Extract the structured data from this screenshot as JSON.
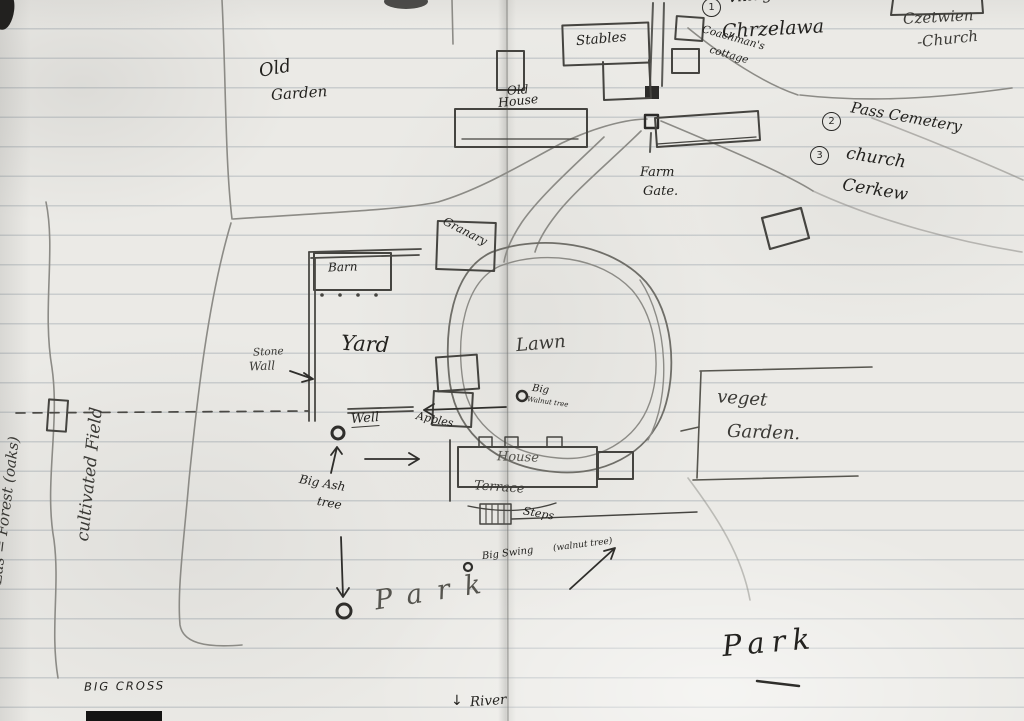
{
  "colors": {
    "paper": "#ebeae6",
    "rule_line": "#7d8a96",
    "pencil_dark": "#23221f",
    "pencil": "#3b3a36",
    "pencil_light": "#8c8b86"
  },
  "labels": {
    "village": {
      "num": "1",
      "line1": "village",
      "line2": "Chrzelawa"
    },
    "czetwien_church": {
      "line1": "Czetwien",
      "line2": "-Church"
    },
    "pass_cemetery": {
      "num": "2",
      "text": "Pass Cemetery"
    },
    "church_cerkew": {
      "num": "3",
      "line1": "church",
      "line2": "Cerkew"
    },
    "stables": "Stables",
    "coachmans_cottage": {
      "line1": "Coachman's",
      "line2": "cottage"
    },
    "old_garden": {
      "line1": "Old",
      "line2": "Garden"
    },
    "old_house": {
      "line1": "Old",
      "line2": "House"
    },
    "farm_gate": {
      "line1": "Farm",
      "line2": "Gate."
    },
    "forest": "Las = Forest (oaks)",
    "cultivated_field": "cultivated Field",
    "barn": "Barn",
    "granary": "Granary",
    "stone_wall": {
      "line1": "Stone",
      "line2": "Wall"
    },
    "yard": "Yard",
    "lawn": "Lawn",
    "big_walnut": {
      "line1": "Big",
      "line2": "Walnut tree"
    },
    "well": "Well",
    "apples": "Apples",
    "house": "House",
    "terrace": "Terrace",
    "steps": "Steps",
    "veget_garden": {
      "line1": "veget",
      "line2": "Garden."
    },
    "big_ash": {
      "line1": "Big Ash",
      "line2": "tree"
    },
    "park_center": "Park",
    "big_swing": {
      "text": "Big Swing",
      "note": "(walnut tree)"
    },
    "park_bottom": "Park",
    "big_cross": "BIG CROSS",
    "river": {
      "arrow": "↓",
      "text": "River"
    }
  }
}
